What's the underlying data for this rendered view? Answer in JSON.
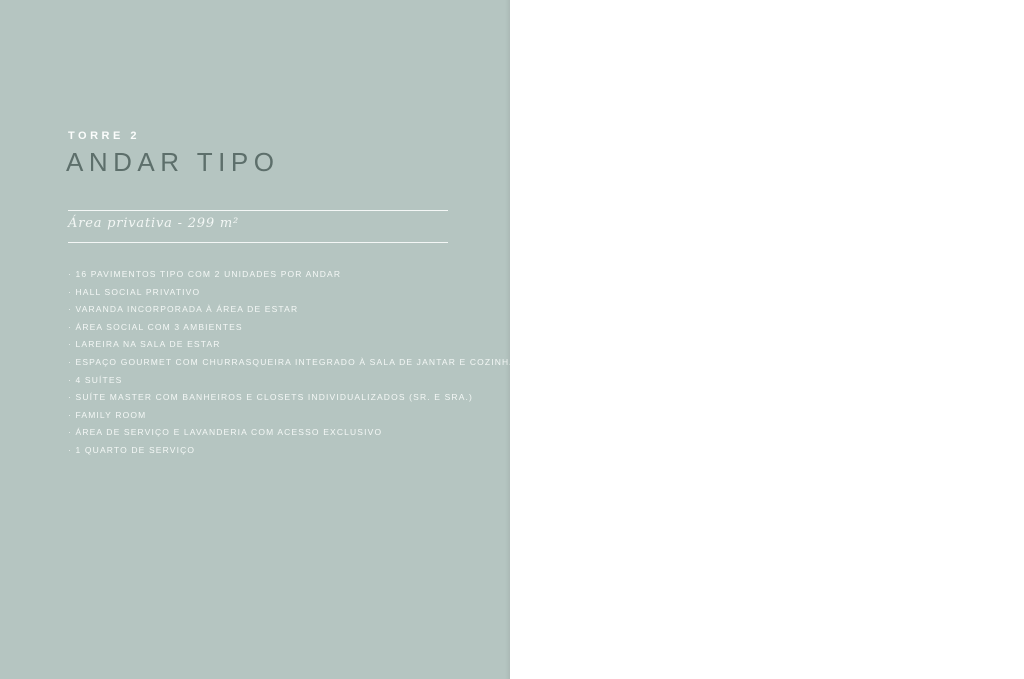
{
  "page": {
    "left_panel": {
      "eyebrow": "TORRE 2",
      "title": "ANDAR TIPO",
      "subtitle": "Área privativa - 299 m²",
      "features": [
        "16 PAVIMENTOS TIPO COM 2 UNIDADES POR ANDAR",
        "HALL SOCIAL PRIVATIVO",
        "VARANDA INCORPORADA À ÁREA DE ESTAR",
        "ÁREA SOCIAL COM 3 AMBIENTES",
        "LAREIRA NA SALA DE ESTAR",
        "ESPAÇO GOURMET COM CHURRASQUEIRA INTEGRADO À SALA DE JANTAR E COZINHA",
        "4 SUÍTES",
        "SUÍTE MASTER COM BANHEIROS E CLOSETS INDIVIDUALIZADOS (SR. E SRA.)",
        "FAMILY ROOM",
        "ÁREA DE SERVIÇO E LAVANDERIA COM ACESSO EXCLUSIVO",
        "1 QUARTO DE SERVIÇO"
      ]
    },
    "right_panel": {
      "compass_label": "N",
      "page_number": "102 - 103",
      "keyplan_caption_line1": "TORRE 2 / COLUNAS 1 E 2",
      "keyplan_caption_line2": "2º AO 17º PAVIMENTO",
      "logo_letter_1": "I",
      "logo_letter_2": "V"
    }
  },
  "colors": {
    "panel": "#b5c5c1",
    "title": "#5d6f6b",
    "wood": "#d9c29c",
    "tile": "#f0f1f0",
    "cream": "#f4efe5",
    "rug": "#c9ccc8",
    "wall": "#2d2d2d",
    "green_chair": "#5d7852",
    "logo_dark": "#33594f",
    "logo_light": "#a3bcb4"
  },
  "floorplan": {
    "rooms": [
      {
        "x": 28,
        "y": 46,
        "lines": [
          "BANHO",
          "SUÍTE 2",
          "4,30m²"
        ]
      },
      {
        "x": 76,
        "y": 40,
        "lines": [
          "SUÍTE 2",
          "11,46m²"
        ]
      },
      {
        "x": 120,
        "y": 46,
        "lines": [
          "BANHO",
          "SUÍTE 3",
          "4,30m²"
        ]
      },
      {
        "x": 158,
        "y": 38,
        "lines": [
          "SUÍTE 3",
          "11,46m²"
        ]
      },
      {
        "x": 26,
        "y": 118,
        "lines": [
          "BANHO",
          "SENHORA",
          "5,88m²"
        ]
      },
      {
        "x": 73,
        "y": 120,
        "lines": [
          "CLOSET",
          "SENHORA",
          "7,36m²"
        ]
      },
      {
        "x": 138,
        "y": 128,
        "lines": [
          "SALA ÍNTIMA",
          "21,05m²"
        ]
      },
      {
        "x": 26,
        "y": 172,
        "lines": [
          "BANHO",
          "SENHOR",
          "5,88m²"
        ]
      },
      {
        "x": 73,
        "y": 174,
        "lines": [
          "CLOSET",
          "SENHOR",
          "5,88m²"
        ]
      },
      {
        "x": 56,
        "y": 214,
        "lines": [
          "SUÍTE MASTER",
          "23,01m²"
        ]
      },
      {
        "x": 147,
        "y": 172,
        "lines": [
          "LAVABO",
          "3,88m²"
        ]
      },
      {
        "x": 147,
        "y": 196,
        "lines": [
          "BANHO",
          "SUÍTE 1",
          "3,58m²"
        ]
      },
      {
        "x": 117,
        "y": 218,
        "lines": [
          "SUÍTE 1",
          "11,74m²"
        ]
      },
      {
        "x": 207,
        "y": 90,
        "lines": [
          "QUARTO",
          "SERVIÇO",
          "4,96m²"
        ]
      },
      {
        "x": 258,
        "y": 110,
        "lines": [
          "ÁREA",
          "SERVIÇO",
          "11,78m²"
        ]
      },
      {
        "x": 288,
        "y": 112,
        "lines": [
          "COZINHA",
          "13,76m²"
        ]
      },
      {
        "x": 197,
        "y": 136,
        "lines": [
          "DEP.",
          "1,31m²"
        ]
      },
      {
        "x": 223,
        "y": 136,
        "lines": [
          "W.C.",
          "2,16m²"
        ]
      },
      {
        "x": 200,
        "y": 170,
        "lines": [
          "HALL",
          "SOCIAL",
          "5,50m²"
        ]
      },
      {
        "x": 237,
        "y": 172,
        "lines": [
          "ELEVADOR",
          "SOCIAL"
        ]
      },
      {
        "x": 308,
        "y": 166,
        "lines": [
          "GOURMET",
          "8,16m²"
        ]
      },
      {
        "x": 253,
        "y": 220,
        "lines": [
          "SALA DE",
          "ESTAR / JANTAR",
          "71,85m²"
        ]
      }
    ],
    "scalebar": {
      "ticks": [
        240,
        254,
        268,
        304,
        332
      ],
      "labels": [
        {
          "x": 247,
          "v": "1,20"
        },
        {
          "x": 261,
          "v": "2,05"
        },
        {
          "x": 286,
          "v": "5,20"
        },
        {
          "x": 318,
          "v": "3,20"
        }
      ]
    }
  }
}
